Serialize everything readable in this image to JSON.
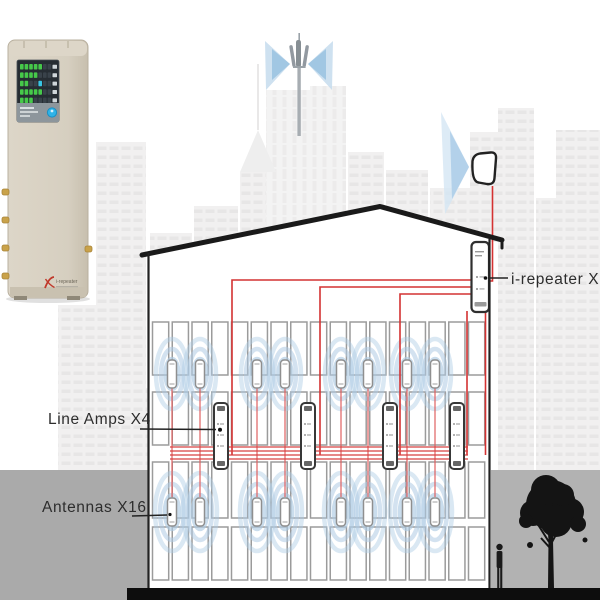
{
  "diagram": {
    "labels": {
      "repeater": "i-repeater X1",
      "line_amps": "Line Amps X4",
      "antennas": "Antennas X16"
    },
    "system_counts": {
      "repeaters": 1,
      "line_amps": 4,
      "antennas": 16
    }
  },
  "device_photo": {
    "logo_text": "i-repeater",
    "led_lit_counts": [
      5,
      4,
      2,
      5,
      3
    ],
    "power_button_color": "#2fb3e8"
  },
  "colors": {
    "cable_red": "#d43232",
    "signal_blue": "#aecbe4",
    "ground_gray": "#ababab",
    "device_beige": "#d8d1c2"
  }
}
